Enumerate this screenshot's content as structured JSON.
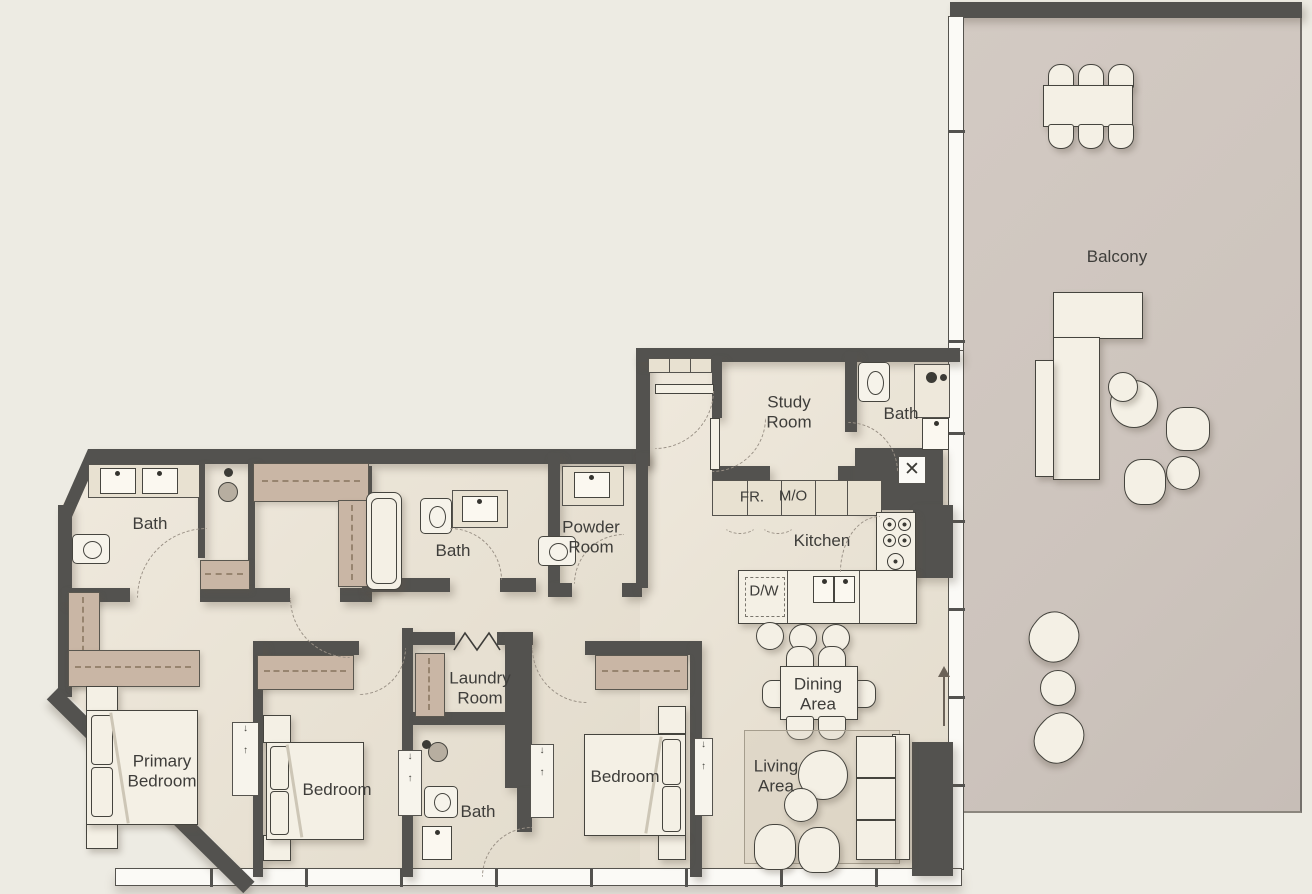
{
  "plan": {
    "rooms": {
      "balcony": "Balcony",
      "study_room": "Study Room",
      "bath_top_right": "Bath",
      "bath_left": "Bath",
      "bath_middle": "Bath",
      "bath_bottom": "Bath",
      "powder_room": "Powder Room",
      "kitchen": "Kitchen",
      "laundry_room": "Laundry Room",
      "primary_bedroom": "Primary Bedroom",
      "bedroom_middle": "Bedroom",
      "bedroom_right": "Bedroom",
      "dining_area": "Dining Area",
      "living_area": "Living Area"
    },
    "appliances": {
      "fridge": "FR.",
      "micro_oven": "M/O",
      "dishwasher": "D/W"
    },
    "colors": {
      "wall": "#53524f",
      "floor": "#e9e2d4",
      "balcony_floor": "#cfc6bf",
      "wardrobe": "#c9b6a5",
      "background": "#edebe3"
    }
  }
}
